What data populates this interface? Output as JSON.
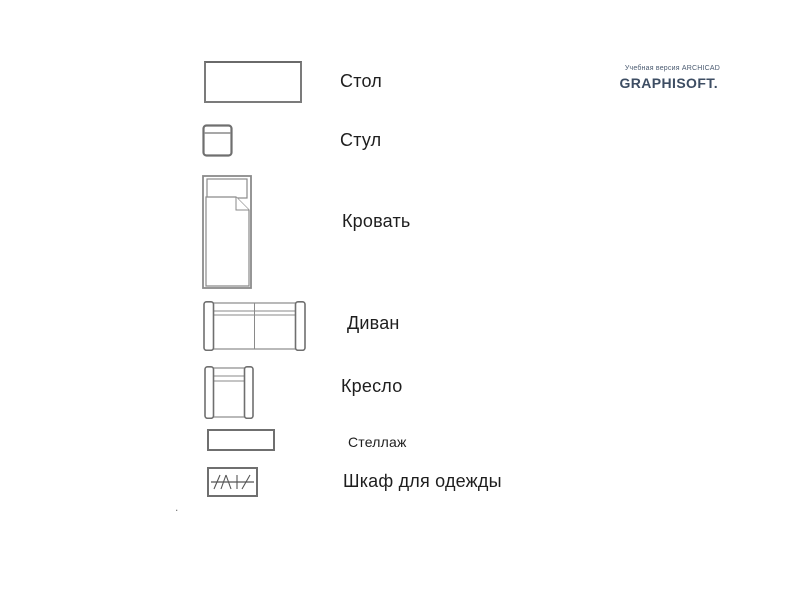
{
  "page": {
    "background": "#ffffff"
  },
  "watermark": {
    "line1": "Учебная версия ARCHICAD",
    "brand": "GRAPHISOFT.",
    "color": "#3d4d63"
  },
  "legend": {
    "items": [
      {
        "id": "table",
        "label": "Стол",
        "symbol": "table-plan-symbol"
      },
      {
        "id": "chair",
        "label": "Стул",
        "symbol": "chair-plan-symbol"
      },
      {
        "id": "bed",
        "label": "Кровать",
        "symbol": "bed-plan-symbol"
      },
      {
        "id": "sofa",
        "label": "Диван",
        "symbol": "sofa-plan-symbol"
      },
      {
        "id": "armchair",
        "label": "Кресло",
        "symbol": "armchair-plan-symbol"
      },
      {
        "id": "shelving",
        "label": "Стеллаж",
        "symbol": "shelving-plan-symbol"
      },
      {
        "id": "wardrobe",
        "label": "Шкаф для одежды",
        "symbol": "wardrobe-plan-symbol"
      }
    ]
  },
  "misc": {
    "stray_dot": "."
  },
  "colors": {
    "symbol_stroke": "#7b7b7b",
    "label_text": "#1e1e1e"
  }
}
